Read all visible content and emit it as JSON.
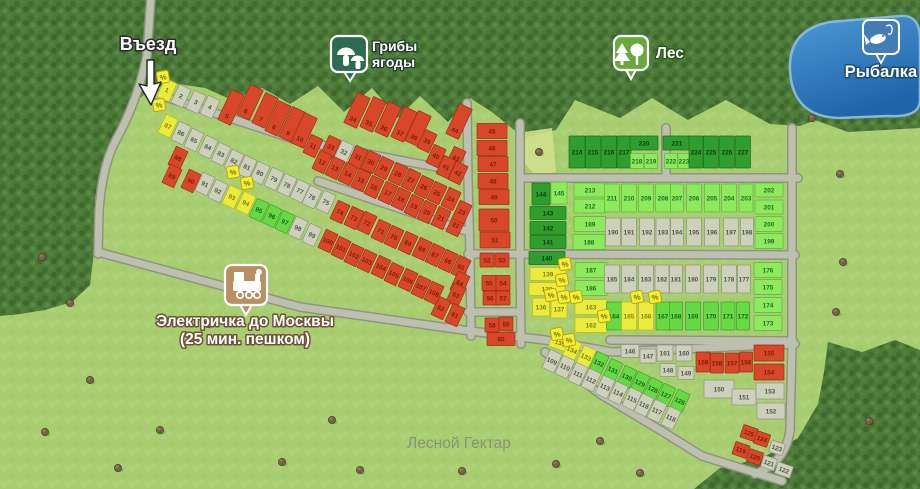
{
  "watermark": "Лесной Гектар",
  "pois": {
    "entrance": {
      "label": "Въезд"
    },
    "mushrooms": {
      "label1": "Грибы",
      "label2": "ягоды"
    },
    "forest": {
      "label": "Лес"
    },
    "fishing": {
      "label": "Рыбалка"
    },
    "train": {
      "label1": "Электричка до Москвы",
      "label2": "(25 мин. пешком)"
    }
  },
  "discount_symbol": "%",
  "plot_status_colors": {
    "R": "#d9472b",
    "G": "#cdd1bc",
    "Y": "#ebeb3d",
    "g": "#66d944",
    "L": "#8fe95e",
    "D": "#2f9e2f"
  },
  "discount_badges": [
    [
      163,
      77
    ],
    [
      159,
      105
    ],
    [
      233,
      172
    ],
    [
      247,
      183
    ],
    [
      565,
      264
    ],
    [
      562,
      280
    ],
    [
      551,
      295
    ],
    [
      564,
      297
    ],
    [
      576,
      297
    ],
    [
      604,
      316
    ],
    [
      637,
      297
    ],
    [
      655,
      297
    ],
    [
      557,
      334
    ],
    [
      569,
      340
    ]
  ],
  "plots": [
    [
      1,
      167,
      90,
      "Y",
      "d"
    ],
    [
      2,
      181,
      96,
      "G",
      "d"
    ],
    [
      3,
      196,
      102,
      "G",
      "d"
    ],
    [
      4,
      210,
      107,
      "G",
      "d"
    ],
    [
      5,
      227,
      116,
      "R",
      "t"
    ],
    [
      6,
      246,
      111,
      "R",
      "t"
    ],
    [
      7,
      261,
      119,
      "R",
      "t"
    ],
    [
      8,
      274,
      127,
      "R",
      "t"
    ],
    [
      9,
      288,
      133,
      "R",
      "t"
    ],
    [
      10,
      300,
      139,
      "R",
      "t"
    ],
    [
      11,
      313,
      146,
      "R",
      "d"
    ],
    [
      34,
      353,
      119,
      "R",
      "t"
    ],
    [
      35,
      369,
      123,
      "R",
      "t"
    ],
    [
      36,
      384,
      128,
      "R",
      "t"
    ],
    [
      37,
      400,
      133,
      "R",
      "t"
    ],
    [
      38,
      414,
      137,
      "R",
      "t"
    ],
    [
      39,
      427,
      141,
      "R",
      "d"
    ],
    [
      44,
      455,
      130,
      "R",
      "t"
    ],
    [
      40,
      436,
      156,
      "R",
      "d"
    ],
    [
      43,
      456,
      158,
      "R",
      "d"
    ],
    [
      41,
      446,
      167,
      "R",
      "d"
    ],
    [
      42,
      458,
      173,
      "R",
      "d"
    ],
    [
      33,
      331,
      147,
      "R",
      "d"
    ],
    [
      32,
      344,
      152,
      "G",
      "d"
    ],
    [
      31,
      358,
      157,
      "R",
      "d"
    ],
    [
      30,
      371,
      162,
      "R",
      "d"
    ],
    [
      29,
      384,
      168,
      "R",
      "d"
    ],
    [
      28,
      398,
      174,
      "R",
      "d"
    ],
    [
      27,
      411,
      180,
      "R",
      "d"
    ],
    [
      26,
      424,
      187,
      "R",
      "d"
    ],
    [
      25,
      437,
      193,
      "R",
      "d"
    ],
    [
      24,
      451,
      199,
      "R",
      "d"
    ],
    [
      12,
      322,
      162,
      "R",
      "d"
    ],
    [
      13,
      335,
      168,
      "R",
      "d"
    ],
    [
      14,
      348,
      174,
      "R",
      "d"
    ],
    [
      15,
      361,
      180,
      "R",
      "d"
    ],
    [
      16,
      374,
      187,
      "R",
      "d"
    ],
    [
      17,
      388,
      193,
      "R",
      "d"
    ],
    [
      18,
      401,
      199,
      "R",
      "d"
    ],
    [
      19,
      414,
      206,
      "R",
      "d"
    ],
    [
      20,
      427,
      212,
      "R",
      "d"
    ],
    [
      21,
      441,
      218,
      "R",
      "d"
    ],
    [
      22,
      456,
      225,
      "R",
      "d"
    ],
    [
      23,
      462,
      212,
      "R",
      "d"
    ],
    [
      87,
      168,
      126,
      "Y",
      "d"
    ],
    [
      86,
      181,
      133,
      "G",
      "d"
    ],
    [
      85,
      194,
      140,
      "G",
      "d"
    ],
    [
      84,
      208,
      147,
      "G",
      "d"
    ],
    [
      83,
      221,
      154,
      "G",
      "d"
    ],
    [
      82,
      234,
      161,
      "G",
      "d"
    ],
    [
      81,
      247,
      167,
      "G",
      "d"
    ],
    [
      80,
      260,
      173,
      "G",
      "d"
    ],
    [
      79,
      274,
      179,
      "G",
      "d"
    ],
    [
      78,
      287,
      185,
      "G",
      "d"
    ],
    [
      77,
      300,
      191,
      "G",
      "d"
    ],
    [
      76,
      312,
      197,
      "G",
      "d"
    ],
    [
      75,
      326,
      202,
      "G",
      "d"
    ],
    [
      74,
      340,
      212,
      "R",
      "d"
    ],
    [
      73,
      354,
      218,
      "R",
      "d"
    ],
    [
      72,
      367,
      223,
      "R",
      "d"
    ],
    [
      71,
      381,
      231,
      "R",
      "d"
    ],
    [
      70,
      394,
      237,
      "R",
      "d"
    ],
    [
      69,
      408,
      243,
      "R",
      "d"
    ],
    [
      68,
      422,
      249,
      "R",
      "d"
    ],
    [
      67,
      435,
      255,
      "R",
      "d"
    ],
    [
      66,
      448,
      261,
      "R",
      "d"
    ],
    [
      65,
      461,
      267,
      "R",
      "d"
    ],
    [
      64,
      460,
      283,
      "R",
      "d"
    ],
    [
      63,
      456,
      295,
      "R",
      "d"
    ],
    [
      62,
      441,
      308,
      "R",
      "d"
    ],
    [
      61,
      455,
      315,
      "R",
      "d"
    ],
    [
      88,
      178,
      158,
      "R",
      "d"
    ],
    [
      89,
      172,
      176,
      "R",
      "d"
    ],
    [
      90,
      191,
      181,
      "R",
      "d"
    ],
    [
      91,
      205,
      184,
      "G",
      "d"
    ],
    [
      92,
      218,
      191,
      "G",
      "d"
    ],
    [
      93,
      232,
      197,
      "Y",
      "d"
    ],
    [
      94,
      246,
      203,
      "Y",
      "d"
    ],
    [
      95,
      259,
      210,
      "g",
      "d"
    ],
    [
      96,
      272,
      216,
      "g",
      "d"
    ],
    [
      97,
      285,
      222,
      "g",
      "d"
    ],
    [
      98,
      298,
      228,
      "G",
      "d"
    ],
    [
      99,
      312,
      235,
      "G",
      "d"
    ],
    [
      100,
      328,
      241,
      "R",
      "d"
    ],
    [
      101,
      341,
      248,
      "R",
      "d"
    ],
    [
      102,
      354,
      255,
      "R",
      "d"
    ],
    [
      103,
      367,
      261,
      "R",
      "d"
    ],
    [
      104,
      381,
      267,
      "R",
      "d"
    ],
    [
      105,
      394,
      274,
      "R",
      "d"
    ],
    [
      106,
      408,
      280,
      "R",
      "d"
    ],
    [
      107,
      421,
      287,
      "R",
      "d"
    ],
    [
      108,
      434,
      293,
      "R",
      "d"
    ],
    [
      45,
      492,
      131,
      "R",
      "o",
      30,
      15
    ],
    [
      46,
      492,
      148,
      "R",
      "o",
      30,
      15
    ],
    [
      47,
      493,
      164,
      "R",
      "o",
      30,
      15
    ],
    [
      48,
      493,
      181,
      "R",
      "o",
      30,
      15
    ],
    [
      49,
      494,
      197,
      "R",
      "o",
      30,
      15
    ],
    [
      50,
      494,
      220,
      "R",
      "o",
      30,
      22
    ],
    [
      51,
      495,
      240,
      "R",
      "o",
      30,
      16
    ],
    [
      52,
      487,
      260,
      "R",
      "o",
      14,
      14
    ],
    [
      53,
      502,
      260,
      "R",
      "o",
      14,
      14
    ],
    [
      55,
      489,
      283,
      "R",
      "o",
      14,
      15
    ],
    [
      54,
      503,
      283,
      "R",
      "o",
      14,
      15
    ],
    [
      56,
      490,
      298,
      "R",
      "o",
      14,
      14
    ],
    [
      57,
      503,
      298,
      "R",
      "o",
      14,
      14
    ],
    [
      58,
      492,
      325,
      "R",
      "o",
      14,
      14
    ],
    [
      59,
      506,
      324,
      "R",
      "o",
      14,
      14
    ],
    [
      60,
      501,
      339,
      "R",
      "o",
      28,
      13
    ],
    [
      144,
      541,
      194,
      "D",
      "o",
      18,
      22
    ],
    [
      145,
      559,
      193,
      "L",
      "o",
      16,
      22
    ],
    [
      143,
      548,
      213,
      "D",
      "o",
      36,
      13
    ],
    [
      142,
      548,
      228,
      "D",
      "o",
      36,
      13
    ],
    [
      141,
      548,
      242,
      "D",
      "o",
      36,
      13
    ],
    [
      140,
      547,
      258,
      "D",
      "o",
      36,
      13
    ],
    [
      139,
      548,
      274,
      "Y",
      "o",
      36,
      13
    ],
    [
      138,
      547,
      289,
      "Y",
      "o",
      36,
      13
    ],
    [
      136,
      541,
      307,
      "Y",
      "o",
      17,
      18
    ],
    [
      137,
      559,
      309,
      "Y",
      "o",
      16,
      18
    ],
    [
      135,
      560,
      343,
      "Y",
      "c",
      20,
      13
    ],
    [
      214,
      577,
      152,
      "D",
      "o",
      16,
      32
    ],
    [
      215,
      593,
      152,
      "D",
      "o",
      15,
      32
    ],
    [
      216,
      609,
      152,
      "D",
      "o",
      15,
      32
    ],
    [
      217,
      624,
      152,
      "D",
      "o",
      14,
      32
    ],
    [
      220,
      644,
      143,
      "D",
      "o",
      28,
      14
    ],
    [
      218,
      637,
      161,
      "L",
      "o",
      13,
      15
    ],
    [
      219,
      651,
      161,
      "L",
      "o",
      13,
      15
    ],
    [
      221,
      677,
      143,
      "D",
      "o",
      28,
      14
    ],
    [
      222,
      671,
      161,
      "L",
      "o",
      13,
      15
    ],
    [
      223,
      684,
      161,
      "L",
      "o",
      12,
      15
    ],
    [
      224,
      696,
      152,
      "D",
      "o",
      14,
      32
    ],
    [
      225,
      711,
      152,
      "D",
      "o",
      15,
      32
    ],
    [
      226,
      727,
      152,
      "D",
      "o",
      15,
      32
    ],
    [
      227,
      743,
      152,
      "D",
      "o",
      15,
      32
    ],
    [
      213,
      590,
      190,
      "L",
      "o",
      32,
      14
    ],
    [
      212,
      590,
      206,
      "L",
      "o",
      32,
      14
    ],
    [
      189,
      590,
      224,
      "L",
      "o",
      32,
      15
    ],
    [
      188,
      589,
      242,
      "L",
      "o",
      32,
      15
    ],
    [
      211,
      612,
      198,
      "L",
      "o",
      15,
      28
    ],
    [
      210,
      629,
      198,
      "L",
      "o",
      15,
      28
    ],
    [
      209,
      646,
      198,
      "L",
      "o",
      15,
      28
    ],
    [
      208,
      663,
      198,
      "L",
      "o",
      15,
      28
    ],
    [
      207,
      677,
      198,
      "L",
      "o",
      13,
      28
    ],
    [
      206,
      694,
      198,
      "L",
      "o",
      15,
      28
    ],
    [
      205,
      712,
      198,
      "L",
      "o",
      15,
      28
    ],
    [
      204,
      729,
      198,
      "L",
      "o",
      15,
      28
    ],
    [
      203,
      746,
      198,
      "L",
      "o",
      14,
      28
    ],
    [
      190,
      613,
      232,
      "G",
      "o",
      15,
      28
    ],
    [
      191,
      629,
      232,
      "G",
      "o",
      15,
      28
    ],
    [
      192,
      647,
      232,
      "G",
      "o",
      15,
      28
    ],
    [
      193,
      663,
      232,
      "G",
      "o",
      14,
      28
    ],
    [
      194,
      677,
      232,
      "G",
      "o",
      13,
      28
    ],
    [
      195,
      694,
      232,
      "G",
      "o",
      15,
      28
    ],
    [
      196,
      712,
      232,
      "G",
      "o",
      15,
      28
    ],
    [
      197,
      731,
      232,
      "G",
      "o",
      15,
      28
    ],
    [
      198,
      747,
      232,
      "G",
      "o",
      13,
      28
    ],
    [
      202,
      769,
      190,
      "L",
      "o",
      28,
      14
    ],
    [
      201,
      769,
      207,
      "L",
      "o",
      28,
      14
    ],
    [
      200,
      769,
      224,
      "L",
      "o",
      28,
      15
    ],
    [
      199,
      769,
      241,
      "L",
      "o",
      28,
      15
    ],
    [
      187,
      591,
      270,
      "L",
      "o",
      32,
      15
    ],
    [
      186,
      591,
      288,
      "L",
      "o",
      32,
      15
    ],
    [
      163,
      591,
      307,
      "Y",
      "o",
      32,
      15
    ],
    [
      162,
      591,
      325,
      "Y",
      "o",
      32,
      15
    ],
    [
      185,
      612,
      279,
      "G",
      "o",
      15,
      28
    ],
    [
      184,
      629,
      279,
      "G",
      "o",
      15,
      28
    ],
    [
      183,
      646,
      279,
      "G",
      "o",
      15,
      28
    ],
    [
      182,
      662,
      279,
      "G",
      "o",
      14,
      28
    ],
    [
      181,
      676,
      279,
      "G",
      "o",
      13,
      28
    ],
    [
      180,
      693,
      279,
      "G",
      "o",
      15,
      28
    ],
    [
      179,
      711,
      279,
      "G",
      "o",
      15,
      28
    ],
    [
      178,
      729,
      279,
      "G",
      "o",
      15,
      28
    ],
    [
      177,
      744,
      279,
      "G",
      "o",
      13,
      28
    ],
    [
      164,
      614,
      316,
      "g",
      "o",
      15,
      28
    ],
    [
      165,
      629,
      316,
      "Y",
      "o",
      15,
      28
    ],
    [
      166,
      646,
      316,
      "Y",
      "o",
      15,
      28
    ],
    [
      167,
      663,
      316,
      "g",
      "o",
      14,
      28
    ],
    [
      168,
      676,
      316,
      "g",
      "o",
      13,
      28
    ],
    [
      169,
      693,
      316,
      "g",
      "o",
      15,
      28
    ],
    [
      170,
      711,
      316,
      "g",
      "o",
      15,
      28
    ],
    [
      171,
      728,
      316,
      "g",
      "o",
      14,
      28
    ],
    [
      172,
      743,
      316,
      "g",
      "o",
      13,
      28
    ],
    [
      176,
      768,
      270,
      "L",
      "o",
      28,
      15
    ],
    [
      175,
      768,
      287,
      "L",
      "o",
      28,
      15
    ],
    [
      174,
      768,
      305,
      "L",
      "o",
      28,
      15
    ],
    [
      173,
      768,
      323,
      "L",
      "o",
      28,
      15
    ],
    [
      146,
      630,
      351,
      "G",
      "o",
      18,
      13
    ],
    [
      147,
      648,
      356,
      "G",
      "o",
      16,
      14
    ],
    [
      161,
      665,
      353,
      "G",
      "o",
      16,
      16
    ],
    [
      160,
      684,
      353,
      "G",
      "o",
      16,
      16
    ],
    [
      148,
      668,
      370,
      "G",
      "o",
      16,
      13
    ],
    [
      149,
      686,
      373,
      "G",
      "o",
      16,
      13
    ],
    [
      159,
      703,
      362,
      "R",
      "o",
      14,
      20
    ],
    [
      158,
      717,
      363,
      "R",
      "o",
      13,
      20
    ],
    [
      157,
      732,
      363,
      "R",
      "o",
      14,
      20
    ],
    [
      156,
      746,
      362,
      "R",
      "o",
      13,
      20
    ],
    [
      155,
      769,
      353,
      "R",
      "o",
      30,
      16
    ],
    [
      154,
      769,
      372,
      "R",
      "o",
      30,
      16
    ],
    [
      150,
      719,
      389,
      "G",
      "o",
      30,
      18
    ],
    [
      151,
      744,
      397,
      "G",
      "o",
      24,
      16
    ],
    [
      153,
      770,
      391,
      "G",
      "o",
      28,
      16
    ],
    [
      152,
      771,
      411,
      "G",
      "o",
      28,
      16
    ],
    [
      134,
      572,
      350,
      "Y",
      "d"
    ],
    [
      133,
      586,
      357,
      "Y",
      "d"
    ],
    [
      132,
      599,
      363,
      "g",
      "d"
    ],
    [
      131,
      613,
      370,
      "g",
      "d"
    ],
    [
      130,
      627,
      377,
      "g",
      "d"
    ],
    [
      129,
      640,
      383,
      "g",
      "d"
    ],
    [
      128,
      653,
      389,
      "g",
      "d"
    ],
    [
      127,
      666,
      395,
      "g",
      "d"
    ],
    [
      126,
      680,
      401,
      "g",
      "d"
    ],
    [
      109,
      552,
      361,
      "G",
      "d"
    ],
    [
      110,
      565,
      367,
      "G",
      "d"
    ],
    [
      111,
      578,
      374,
      "G",
      "d"
    ],
    [
      112,
      591,
      380,
      "G",
      "d"
    ],
    [
      113,
      605,
      387,
      "G",
      "d"
    ],
    [
      114,
      618,
      393,
      "G",
      "d"
    ],
    [
      115,
      632,
      399,
      "G",
      "d"
    ],
    [
      116,
      644,
      405,
      "G",
      "d"
    ],
    [
      117,
      657,
      411,
      "G",
      "d"
    ],
    [
      118,
      671,
      418,
      "G",
      "d"
    ],
    [
      125,
      749,
      433,
      "R",
      "c",
      15,
      13
    ],
    [
      124,
      762,
      439,
      "R",
      "c",
      14,
      13
    ],
    [
      119,
      741,
      450,
      "R",
      "c",
      15,
      13
    ],
    [
      120,
      755,
      457,
      "R",
      "c",
      14,
      13
    ],
    [
      123,
      777,
      448,
      "G",
      "c",
      14,
      12
    ],
    [
      121,
      769,
      463,
      "G",
      "c",
      14,
      12
    ],
    [
      122,
      784,
      470,
      "G",
      "c",
      16,
      12
    ]
  ]
}
